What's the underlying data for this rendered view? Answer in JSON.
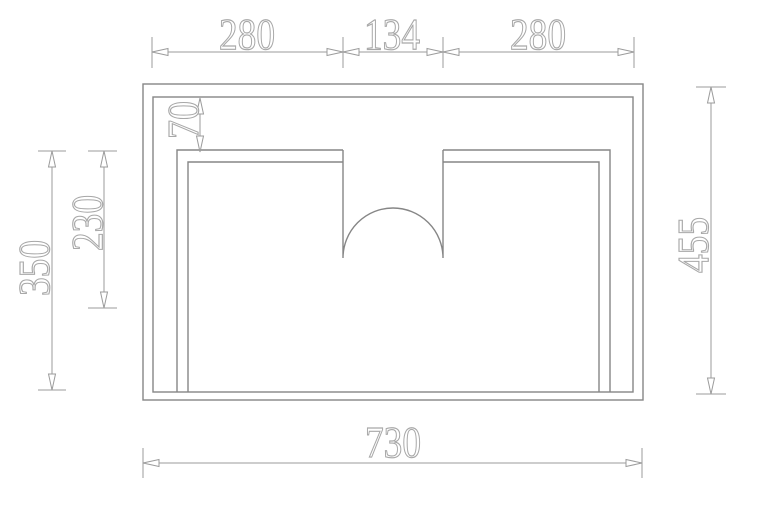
{
  "drawing": {
    "type": "technical-dimension-drawing",
    "dims": {
      "top_left": "280",
      "top_center": "134",
      "top_right": "280",
      "left_outer": "350",
      "left_inner": "230",
      "offset": "70",
      "right": "455",
      "bottom": "730"
    },
    "colors": {
      "background": "#ffffff",
      "drawing_line": "#868686",
      "dimension_line": "#9b9b9b",
      "text_outline": "#a8a8a8"
    }
  }
}
